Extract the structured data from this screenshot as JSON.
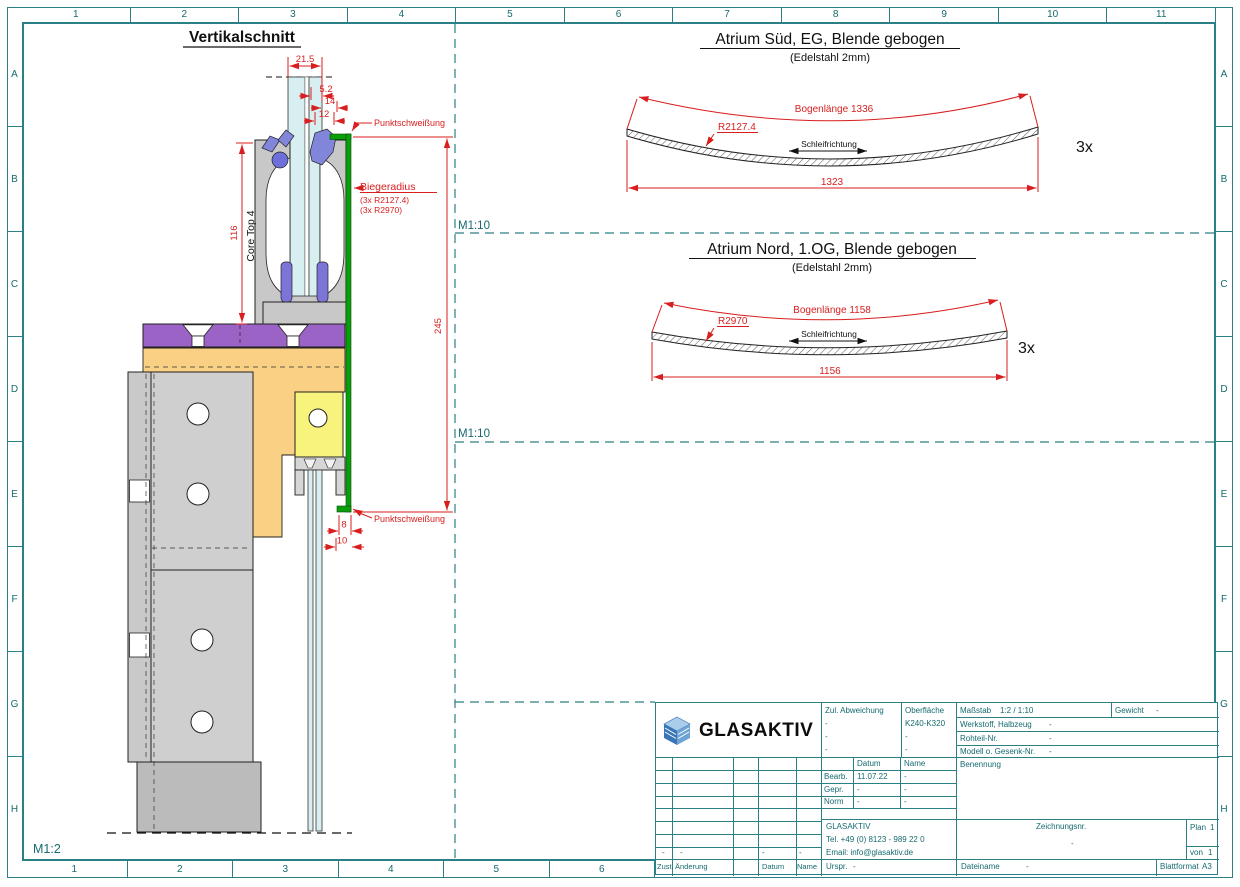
{
  "sheet": {
    "columns": [
      "1",
      "2",
      "3",
      "4",
      "5",
      "6",
      "7",
      "8",
      "9",
      "10",
      "11"
    ],
    "rows": [
      "A",
      "B",
      "C",
      "D",
      "E",
      "F",
      "G",
      "H"
    ],
    "scale_left": "M1:2",
    "scale_right_top": "M1:10",
    "scale_right_mid": "M1:10"
  },
  "section_view": {
    "title": "Vertikalschnitt",
    "profile_label": "Core Top 4",
    "weld_label_top": "Punktschweißung",
    "weld_label_bottom": "Punktschweißung",
    "bend_radius_title": "Biegeradius",
    "bend_radius_line1": "(3x R2127.4)",
    "bend_radius_line2": "(3x R2970)",
    "dim_glass": "21.5",
    "dim_offset1": "5.2",
    "dim_offset2": "14",
    "dim_offset3": "12",
    "dim_clamp_height": "116",
    "dim_blende_height": "245",
    "dim_return1": "8",
    "dim_return2": "10"
  },
  "blende_sued": {
    "title": "Atrium Süd, EG, Blende gebogen",
    "subtitle": "(Edelstahl 2mm)",
    "arc_label": "Bogenlänge 1336",
    "radius": "R2127.4",
    "grind_label": "Schleifrichtung",
    "chord": "1323",
    "quantity": "3x"
  },
  "blende_nord": {
    "title": "Atrium Nord, 1.OG, Blende gebogen",
    "subtitle": "(Edelstahl 2mm)",
    "arc_label": "Bogenlänge 1158",
    "radius": "R2970",
    "grind_label": "Schleifrichtung",
    "chord": "1156",
    "quantity": "3x"
  },
  "title_block": {
    "logo_text": "GLASAKTIV",
    "tolerance_label": "Zul. Abweichung",
    "tolerance_values": [
      "-",
      "-",
      "-"
    ],
    "surface_label": "Oberfläche",
    "surface_value": "K240-K320",
    "surface_extra": [
      "-",
      "-"
    ],
    "scale_label": "Maßstab",
    "scale_value": "1:2 / 1:10",
    "weight_label": "Gewicht",
    "weight_value": "-",
    "material_label": "Werkstoff, Halbzeug",
    "material_value": "-",
    "blank_label": "Rohteil-Nr.",
    "blank_value": "-",
    "model_label": "Modell o. Gesenk-Nr.",
    "model_value": "-",
    "designation_label": "Benennung",
    "date_col": "Datum",
    "name_col": "Name",
    "edited_label": "Bearb.",
    "edited_date": "11.07.22",
    "edited_name": "-",
    "checked_label": "Gepr.",
    "checked_date": "-",
    "checked_name": "-",
    "norm_label": "Norm",
    "norm_date": "-",
    "norm_name": "-",
    "company_name": "GLASAKTIV",
    "company_tel": "Tel. +49 (0) 8123 - 989 22 0",
    "company_email": "Email: info@glasaktiv.de",
    "drawing_no_label": "Zeichnungsnr.",
    "drawing_no_value": "-",
    "plan_label": "Plan",
    "plan_value": "1",
    "of_label": "von",
    "of_value": "1",
    "rev_state_label": "Zust.",
    "rev_change_label": "Änderung",
    "rev_date_label": "Datum",
    "rev_name_label": "Name",
    "origin_label": "Urspr.",
    "origin_value": "-",
    "filename_label": "Dateiname",
    "filename_value": "-",
    "format_label": "Blattformat",
    "format_value": "A3",
    "rev_row_dashes": [
      "-",
      "-",
      "-",
      "-"
    ]
  }
}
